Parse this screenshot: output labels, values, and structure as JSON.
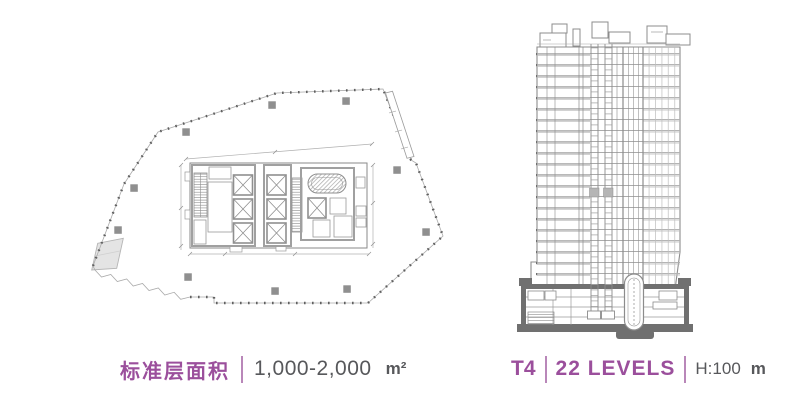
{
  "colors": {
    "accent_purple": "#9b4f9c",
    "divider_purple": "#b987b9",
    "text_dark": "#57585b",
    "drawing_line_gray": "#8c8c8c",
    "column_fill_gray": "#8f8f8f",
    "podium_dark_gray": "#707070",
    "ramp_fill": "#e4e4e4",
    "background": "#ffffff"
  },
  "floor_plan": {
    "title": "标准层面积",
    "area_range": "1,000-2,000",
    "area_unit": "m²"
  },
  "tower": {
    "id": "T4",
    "levels": "22 LEVELS",
    "height": "H:100",
    "height_unit": "m"
  }
}
